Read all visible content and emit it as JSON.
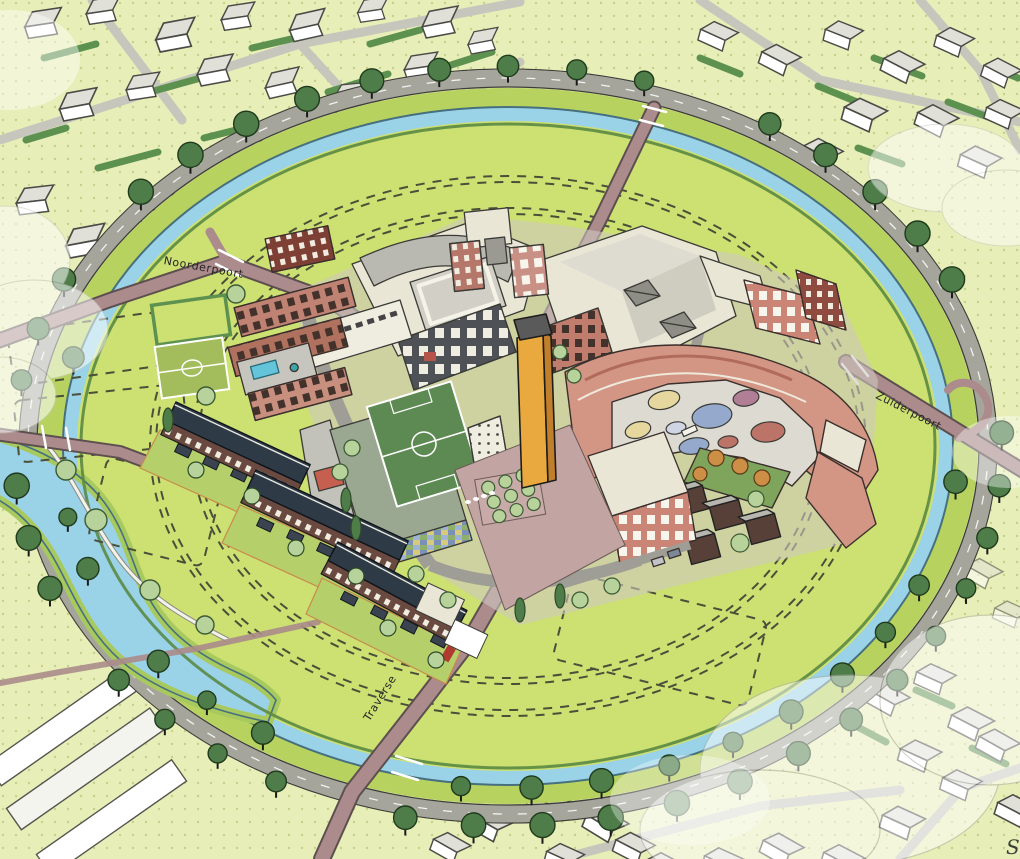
{
  "scene": {
    "kind": "aerial-masterplan-illustration",
    "labels": {
      "north_gate_road": "Noorderpoort",
      "south_gate_road": "Zuiderpoort",
      "main_road": "Traverse",
      "watermark": "S"
    },
    "palette": {
      "outer_ground": "#e7eeb7",
      "meadow": "#cde072",
      "bank": "#b7d25f",
      "water": "#9ad3e8",
      "water_edge": "#47707f",
      "ring_road": "#a5a59c",
      "radial_road": "#ab8b8b",
      "radial_edge": "#5d4f4f",
      "building_cream": "#eae6d6",
      "building_white": "#ffffff",
      "brick": "#c58878",
      "brick_dark": "#8f4b3f",
      "facade_dark": "#4e5256",
      "roof_gray": "#b9b9b1",
      "roof_navy": "#2e3a46",
      "tower_gold": "#e9a93f",
      "pitch_green": "#5d8a52",
      "courtyard_gray": "#dcdad1",
      "blob_blue": "#94a9cb",
      "blob_yellow": "#e6d79e",
      "blob_mauve": "#b07f95",
      "blob_red": "#bd7468",
      "pool_blue": "#64c4da",
      "orange_tree": "#cd8f45",
      "tree_dark": "#4e7d49",
      "tree_light": "#b7d29a",
      "hedge": "#5d9150",
      "cloud": "#ffffff"
    }
  }
}
